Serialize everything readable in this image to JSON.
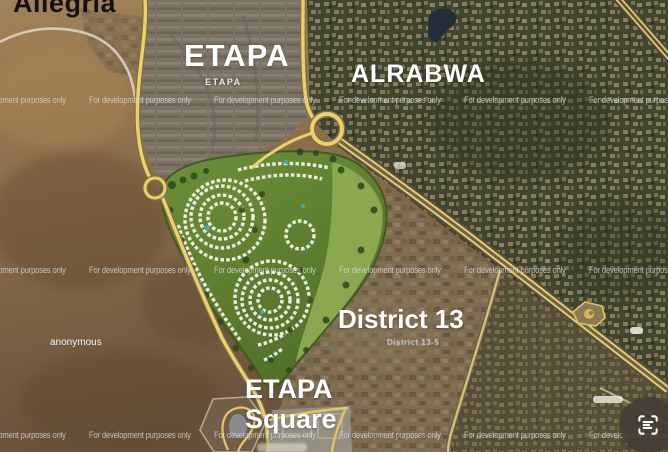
{
  "map": {
    "labels": {
      "allegria": "Allegria",
      "etapa_big": "ETAPA",
      "etapa_small": "ETAPA",
      "alrabwa": "ALRABWA",
      "district13": "District 13",
      "district13_sub": "District 13-5",
      "anonymous": "anonymous",
      "etapa_square_line1": "ETAPA",
      "etapa_square_line2": "Square"
    },
    "watermark": {
      "text": "For development purposes only",
      "rows_y": [
        95,
        265,
        430
      ],
      "cols_x": [
        -36,
        89,
        214,
        339,
        464,
        589
      ]
    },
    "colors": {
      "desert_light": "#a08258",
      "desert_dark": "#6d5439",
      "etapa_area": "#7c7365",
      "alrabwa_area": "#3e4531",
      "district_area": "#7d6b52",
      "site_green": "#6f9138",
      "road_yellow": "#e9cb63",
      "pond": "#232e3a",
      "label_white": "#ffffff"
    },
    "icons": {
      "lens_button": "text-scan-icon"
    }
  }
}
